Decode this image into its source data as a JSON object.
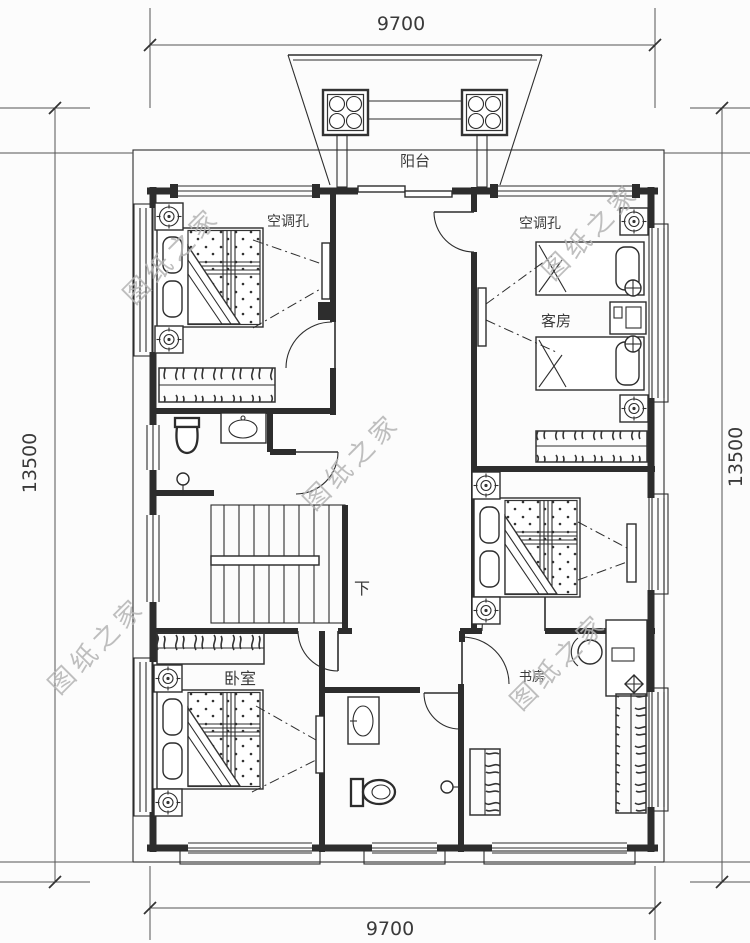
{
  "colors": {
    "line": "#2d2d2d",
    "text": "#3a3a3a",
    "watermark": "#b4b4b4",
    "background": "#fcfcfc"
  },
  "dimensions": {
    "width_top": "9700",
    "width_bottom": "9700",
    "height_left": "13500",
    "height_right": "13500"
  },
  "labels": {
    "balcony": "阳台",
    "ac_hole_left": "空调孔",
    "ac_hole_right": "空调孔",
    "guest_room": "客房",
    "bedroom": "卧室",
    "study": "书房",
    "stairs_down": "下"
  },
  "watermark": {
    "text": "图纸之家"
  }
}
